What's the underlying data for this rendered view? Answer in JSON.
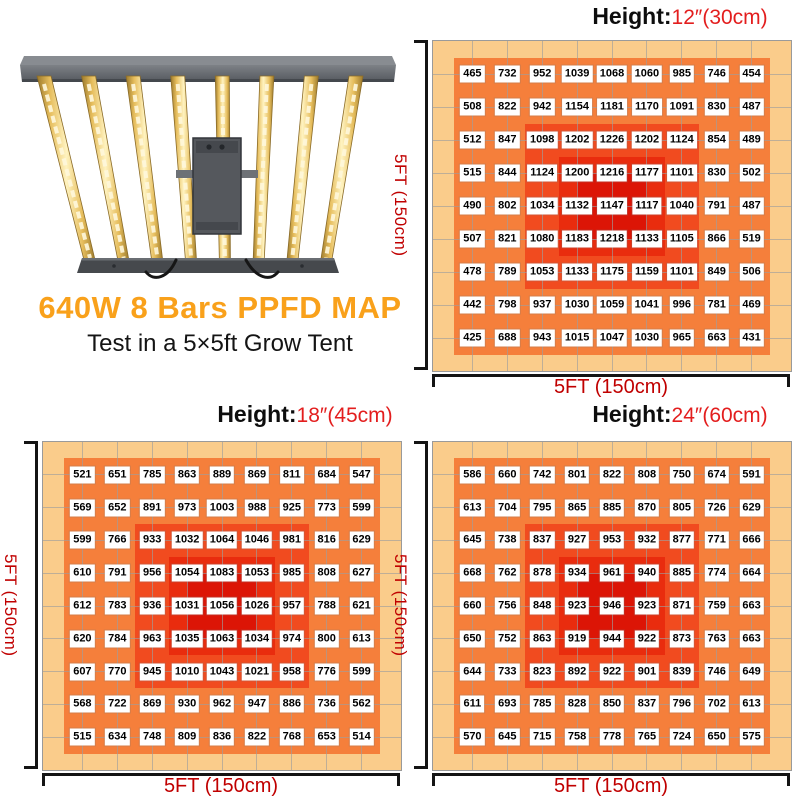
{
  "header": {
    "title": "640W 8 Bars PPFD MAP",
    "subtitle": "Test in a 5×5ft Grow Tent",
    "title_color": "#F9A11B"
  },
  "fixture_image": "8-bar-led-grow-light",
  "colors": {
    "height_value_red": "#E31E1E",
    "axis_label_red": "#C00000",
    "gridline": "#9E9E9E",
    "zone_scale": [
      "#FACC8B",
      "#F57F3B",
      "#F14B1F",
      "#E92C0E",
      "#DC1506"
    ]
  },
  "chart_data": [
    {
      "type": "heatmap",
      "title": "Height:",
      "height_value": "12″(30cm)",
      "xlabel": "5FT (150cm)",
      "ylabel": "5FT (150cm)",
      "grid_size": "9x9",
      "values": [
        [
          465,
          732,
          952,
          1039,
          1068,
          1060,
          985,
          746,
          454
        ],
        [
          508,
          822,
          942,
          1154,
          1181,
          1170,
          1091,
          830,
          487
        ],
        [
          512,
          847,
          1098,
          1202,
          1226,
          1202,
          1124,
          854,
          489
        ],
        [
          515,
          844,
          1124,
          1200,
          1216,
          1177,
          1101,
          830,
          502
        ],
        [
          490,
          802,
          1034,
          1132,
          1147,
          1117,
          1040,
          791,
          487
        ],
        [
          507,
          821,
          1080,
          1183,
          1218,
          1133,
          1105,
          866,
          519
        ],
        [
          478,
          789,
          1053,
          1133,
          1175,
          1159,
          1101,
          849,
          506
        ],
        [
          442,
          798,
          937,
          1030,
          1059,
          1041,
          996,
          781,
          469
        ],
        [
          425,
          688,
          943,
          1015,
          1047,
          1030,
          965,
          663,
          431
        ]
      ]
    },
    {
      "type": "heatmap",
      "title": "Height:",
      "height_value": "18″(45cm)",
      "xlabel": "5FT (150cm)",
      "ylabel": "5FT (150cm)",
      "grid_size": "9x9",
      "values": [
        [
          521,
          651,
          785,
          863,
          889,
          869,
          811,
          684,
          547
        ],
        [
          569,
          652,
          891,
          973,
          1003,
          988,
          925,
          773,
          599
        ],
        [
          599,
          766,
          933,
          1032,
          1064,
          1046,
          981,
          816,
          629
        ],
        [
          610,
          791,
          956,
          1054,
          1083,
          1053,
          985,
          808,
          627
        ],
        [
          612,
          783,
          936,
          1031,
          1056,
          1026,
          957,
          788,
          621
        ],
        [
          620,
          784,
          963,
          1035,
          1063,
          1034,
          974,
          800,
          613
        ],
        [
          607,
          770,
          945,
          1010,
          1043,
          1021,
          958,
          776,
          599
        ],
        [
          568,
          722,
          869,
          930,
          962,
          947,
          886,
          736,
          562
        ],
        [
          515,
          634,
          748,
          809,
          836,
          822,
          768,
          653,
          514
        ]
      ]
    },
    {
      "type": "heatmap",
      "title": "Height:",
      "height_value": "24″(60cm)",
      "xlabel": "5FT (150cm)",
      "ylabel": "5FT (150cm)",
      "grid_size": "9x9",
      "values": [
        [
          586,
          660,
          742,
          801,
          822,
          808,
          750,
          674,
          591
        ],
        [
          613,
          704,
          795,
          865,
          885,
          870,
          805,
          726,
          629
        ],
        [
          645,
          738,
          837,
          927,
          953,
          932,
          877,
          771,
          666
        ],
        [
          668,
          762,
          878,
          934,
          961,
          940,
          885,
          774,
          664
        ],
        [
          660,
          756,
          848,
          923,
          946,
          923,
          871,
          759,
          663
        ],
        [
          650,
          752,
          863,
          919,
          944,
          922,
          873,
          763,
          663
        ],
        [
          644,
          733,
          823,
          892,
          922,
          901,
          839,
          746,
          649
        ],
        [
          611,
          693,
          785,
          828,
          850,
          837,
          796,
          702,
          613
        ],
        [
          570,
          645,
          715,
          758,
          778,
          765,
          724,
          650,
          575
        ]
      ]
    }
  ]
}
